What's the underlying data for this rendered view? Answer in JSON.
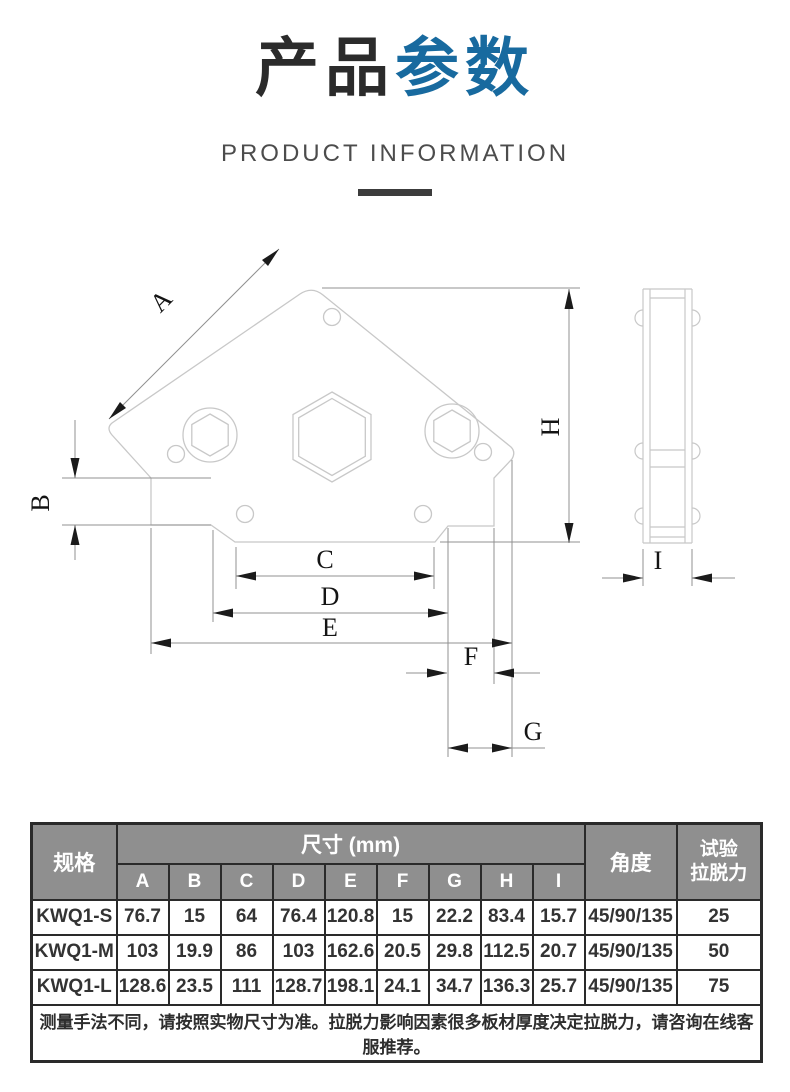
{
  "header": {
    "title_black": "产品",
    "title_blue": "参数",
    "subtitle": "PRODUCT INFORMATION"
  },
  "colors": {
    "accent_blue": "#186a9f",
    "table_header_bg": "#8f8f8f",
    "table_border": "#2a2a2a",
    "drawing_outline": "#c8c8c8",
    "dimension_line": "#909090",
    "arrow_black": "#1b1b1b"
  },
  "diagram": {
    "dimension_labels": [
      "A",
      "B",
      "C",
      "D",
      "E",
      "F",
      "G",
      "H",
      "I"
    ],
    "views": [
      "front-view",
      "side-view"
    ]
  },
  "table": {
    "col_spec": "规格",
    "col_size_group": "尺寸 (mm)",
    "size_columns": [
      "A",
      "B",
      "C",
      "D",
      "E",
      "F",
      "G",
      "H",
      "I"
    ],
    "col_angle": "角度",
    "col_pull_line1": "试验",
    "col_pull_line2": "拉脱力",
    "rows": [
      {
        "spec": "KWQ1-S",
        "values": [
          "76.7",
          "15",
          "64",
          "76.4",
          "120.8",
          "15",
          "22.2",
          "83.4",
          "15.7"
        ],
        "angle": "45/90/135",
        "pull": "25"
      },
      {
        "spec": "KWQ1-M",
        "values": [
          "103",
          "19.9",
          "86",
          "103",
          "162.6",
          "20.5",
          "29.8",
          "112.5",
          "20.7"
        ],
        "angle": "45/90/135",
        "pull": "50"
      },
      {
        "spec": "KWQ1-L",
        "values": [
          "128.6",
          "23.5",
          "111",
          "128.7",
          "198.1",
          "24.1",
          "34.7",
          "136.3",
          "25.7"
        ],
        "angle": "45/90/135",
        "pull": "75"
      }
    ],
    "note": "测量手法不同，请按照实物尺寸为准。拉脱力影响因素很多板材厚度决定拉脱力，请咨询在线客服推荐。"
  }
}
